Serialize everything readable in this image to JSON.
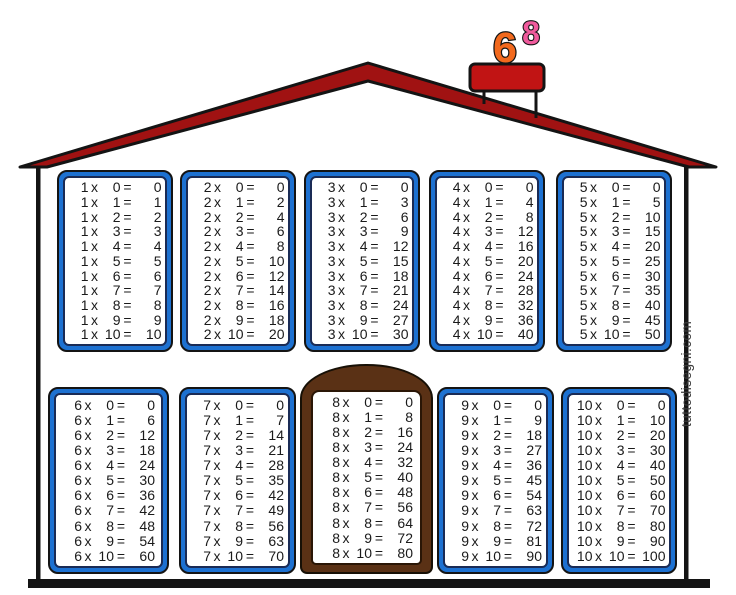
{
  "chimney": {
    "number_large": "6",
    "number_small": "8"
  },
  "watermark": "tuttodisegni.com",
  "colors": {
    "roof_red": "#a01212",
    "chimney_cap_red": "#c11414",
    "window_frame_blue": "#1d71d1",
    "door_brown": "#5a3115",
    "number_orange": "#f2691d",
    "number_pink": "#ef5a9c",
    "outline_black": "#141414",
    "table_text": "#1a1a1a"
  },
  "tables": [
    {
      "factor": "1",
      "rows": [
        "1 x 0 = 0",
        "1 x 1 = 1",
        "1 x 2 = 2",
        "1 x 3 = 3",
        "1 x 4 = 4",
        "1 x 5 = 5",
        "1 x 6 = 6",
        "1 x 7 = 7",
        "1 x 8 = 8",
        "1 x 9 = 9",
        "1 x 10 = 10"
      ]
    },
    {
      "factor": "2",
      "rows": [
        "2 x 0 = 0",
        "2 x 1 = 2",
        "2 x 2 = 4",
        "2 x 3 = 6",
        "2 x 4 = 8",
        "2 x 5 = 10",
        "2 x 6 = 12",
        "2 x 7 = 14",
        "2 x 8 = 16",
        "2 x 9 = 18",
        "2 x 10 = 20"
      ]
    },
    {
      "factor": "3",
      "rows": [
        "3 x 0 = 0",
        "3 x 1 = 3",
        "3 x 2 = 6",
        "3 x 3 = 9",
        "3 x 4 = 12",
        "3 x 5 = 15",
        "3 x 6 = 18",
        "3 x 7 = 21",
        "3 x 8 = 24",
        "3 x 9 = 27",
        "3 x 10 = 30"
      ]
    },
    {
      "factor": "4",
      "rows": [
        "4 x 0 = 0",
        "4 x 1 = 4",
        "4 x 2 = 8",
        "4 x 3 = 12",
        "4 x 4 = 16",
        "4 x 5 = 20",
        "4 x 6 = 24",
        "4 x 7 = 28",
        "4 x 8 = 32",
        "4 x 9 = 36",
        "4 x 10 = 40"
      ]
    },
    {
      "factor": "5",
      "rows": [
        "5 x 0 = 0",
        "5 x 1 = 5",
        "5 x 2 = 10",
        "5 x 3 = 15",
        "5 x 4 = 20",
        "5 x 5 = 25",
        "5 x 6 = 30",
        "5 x 7 = 35",
        "5 x 8 = 40",
        "5 x 9 = 45",
        "5 x 10 = 50"
      ]
    },
    {
      "factor": "6",
      "rows": [
        "6 x 0 = 0",
        "6 x 1 = 6",
        "6 x 2 = 12",
        "6 x 3 = 18",
        "6 x 4 = 24",
        "6 x 5 = 30",
        "6 x 6 = 36",
        "6 x 7 = 42",
        "6 x 8 = 48",
        "6 x 9 = 54",
        "6 x 10 = 60"
      ]
    },
    {
      "factor": "7",
      "rows": [
        "7 x 0 = 0",
        "7 x 1 = 7",
        "7 x 2 = 14",
        "7 x 3 = 21",
        "7 x 4 = 28",
        "7 x 5 = 35",
        "7 x 6 = 42",
        "7 x 7 = 49",
        "7 x 8 = 56",
        "7 x 9 = 63",
        "7 x 10 = 70"
      ]
    },
    {
      "factor": "8",
      "rows": [
        "8 x 0 = 0",
        "8 x 1 = 8",
        "8 x 2 = 16",
        "8 x 3 = 24",
        "8 x 4 = 32",
        "8 x 5 = 40",
        "8 x 6 = 48",
        "8 x 7 = 56",
        "8 x 8 = 64",
        "8 x 9 = 72",
        "8 x 10 = 80"
      ]
    },
    {
      "factor": "9",
      "rows": [
        "9 x 0 = 0",
        "9 x 1 = 9",
        "9 x 2 = 18",
        "9 x 3 = 27",
        "9 x 4 = 36",
        "9 x 5 = 45",
        "9 x 6 = 54",
        "9 x 7 = 63",
        "9 x 8 = 72",
        "9 x 9 = 81",
        "9 x 10 = 90"
      ]
    },
    {
      "factor": "10",
      "rows": [
        "10 x 0 = 0",
        "10 x 1 = 10",
        "10 x 2 = 20",
        "10 x 3 = 30",
        "10 x 4 = 40",
        "10 x 5 = 50",
        "10 x 6 = 60",
        "10 x 7 = 70",
        "10 x 8 = 80",
        "10 x 9 = 90",
        "10 x 10 = 100"
      ]
    }
  ]
}
